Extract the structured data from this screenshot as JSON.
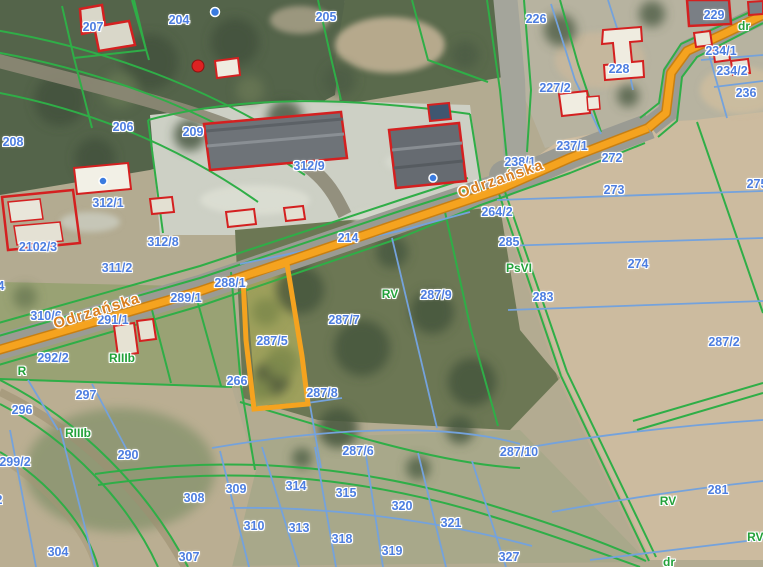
{
  "map": {
    "selected_parcel_id": "287/5",
    "colors": {
      "parcel_label_blue": "#4d7ee0",
      "landuse_label_green": "#23a13a",
      "street_label_orange": "#d97f1e",
      "boundary_green": "#2fae47",
      "boundary_blue": "#74a2dc",
      "building_outline_red": "#d42020",
      "road_highlight_orange": "#f5a31f",
      "selection_orange": "#f5a31f"
    },
    "street_labels": [
      {
        "text": "Odrzańska",
        "x": 97,
        "y": 311,
        "angle": -17
      },
      {
        "text": "Odrzańska",
        "x": 501,
        "y": 179,
        "angle": -19
      }
    ],
    "parcel_labels": [
      {
        "text": "207",
        "x": 93,
        "y": 27
      },
      {
        "text": "204",
        "x": 179,
        "y": 20
      },
      {
        "text": "205",
        "x": 326,
        "y": 17
      },
      {
        "text": "226",
        "x": 536,
        "y": 19
      },
      {
        "text": "229",
        "x": 714,
        "y": 15
      },
      {
        "text": "234/1",
        "x": 721,
        "y": 51
      },
      {
        "text": "234/2",
        "x": 732,
        "y": 71
      },
      {
        "text": "236",
        "x": 746,
        "y": 93
      },
      {
        "text": "228",
        "x": 619,
        "y": 69
      },
      {
        "text": "227/2",
        "x": 555,
        "y": 88
      },
      {
        "text": "208",
        "x": 13,
        "y": 142
      },
      {
        "text": "206",
        "x": 123,
        "y": 127
      },
      {
        "text": "209",
        "x": 193,
        "y": 132
      },
      {
        "text": "312/9",
        "x": 309,
        "y": 166
      },
      {
        "text": "237/1",
        "x": 572,
        "y": 146
      },
      {
        "text": "238/1",
        "x": 520,
        "y": 162
      },
      {
        "text": "272",
        "x": 612,
        "y": 158
      },
      {
        "text": "275",
        "x": 757,
        "y": 184
      },
      {
        "text": "273",
        "x": 614,
        "y": 190
      },
      {
        "text": "312/1",
        "x": 108,
        "y": 203
      },
      {
        "text": "2102/3",
        "x": 38,
        "y": 247
      },
      {
        "text": "264/2",
        "x": 497,
        "y": 212
      },
      {
        "text": "312/8",
        "x": 163,
        "y": 242
      },
      {
        "text": "311/2",
        "x": 117,
        "y": 268
      },
      {
        "text": "285",
        "x": 509,
        "y": 242
      },
      {
        "text": "274",
        "x": 638,
        "y": 264
      },
      {
        "text": "214",
        "x": 348,
        "y": 238
      },
      {
        "text": "288/1",
        "x": 230,
        "y": 283
      },
      {
        "text": "289/1",
        "x": 186,
        "y": 298
      },
      {
        "text": "283",
        "x": 543,
        "y": 297
      },
      {
        "text": "310/6",
        "x": 46,
        "y": 316
      },
      {
        "text": "291/1",
        "x": 113,
        "y": 320
      },
      {
        "text": "294",
        "x": -6,
        "y": 286
      },
      {
        "text": "287/9",
        "x": 436,
        "y": 295
      },
      {
        "text": "287/7",
        "x": 344,
        "y": 320
      },
      {
        "text": "287/5",
        "x": 272,
        "y": 341
      },
      {
        "text": "287/2",
        "x": 724,
        "y": 342
      },
      {
        "text": "292/2",
        "x": 53,
        "y": 358
      },
      {
        "text": "266",
        "x": 237,
        "y": 381
      },
      {
        "text": "287/8",
        "x": 322,
        "y": 393
      },
      {
        "text": "296",
        "x": 22,
        "y": 410
      },
      {
        "text": "297",
        "x": 86,
        "y": 395
      },
      {
        "text": "287/6",
        "x": 358,
        "y": 451
      },
      {
        "text": "287/10",
        "x": 519,
        "y": 452
      },
      {
        "text": "299/2",
        "x": 15,
        "y": 462
      },
      {
        "text": "290",
        "x": 128,
        "y": 455
      },
      {
        "text": "302",
        "x": -8,
        "y": 500
      },
      {
        "text": "304",
        "x": 58,
        "y": 552
      },
      {
        "text": "307",
        "x": 189,
        "y": 557
      },
      {
        "text": "308",
        "x": 194,
        "y": 498
      },
      {
        "text": "309",
        "x": 236,
        "y": 489
      },
      {
        "text": "310",
        "x": 254,
        "y": 526
      },
      {
        "text": "313",
        "x": 299,
        "y": 528
      },
      {
        "text": "314",
        "x": 296,
        "y": 486
      },
      {
        "text": "315",
        "x": 346,
        "y": 493
      },
      {
        "text": "318",
        "x": 342,
        "y": 539
      },
      {
        "text": "319",
        "x": 392,
        "y": 551
      },
      {
        "text": "320",
        "x": 402,
        "y": 506
      },
      {
        "text": "321",
        "x": 451,
        "y": 523
      },
      {
        "text": "327",
        "x": 509,
        "y": 557
      },
      {
        "text": "281",
        "x": 718,
        "y": 490
      }
    ],
    "landuse_labels": [
      {
        "text": "dr",
        "x": 744,
        "y": 26
      },
      {
        "text": "dr",
        "x": 669,
        "y": 562
      },
      {
        "text": "R",
        "x": 22,
        "y": 371
      },
      {
        "text": "RIIIb",
        "x": 122,
        "y": 358
      },
      {
        "text": "RIIIb",
        "x": 78,
        "y": 433
      },
      {
        "text": "RV",
        "x": 390,
        "y": 294
      },
      {
        "text": "RV",
        "x": 668,
        "y": 501
      },
      {
        "text": "PsVI",
        "x": 519,
        "y": 268
      },
      {
        "text": "RVI",
        "x": 757,
        "y": 537
      }
    ]
  }
}
